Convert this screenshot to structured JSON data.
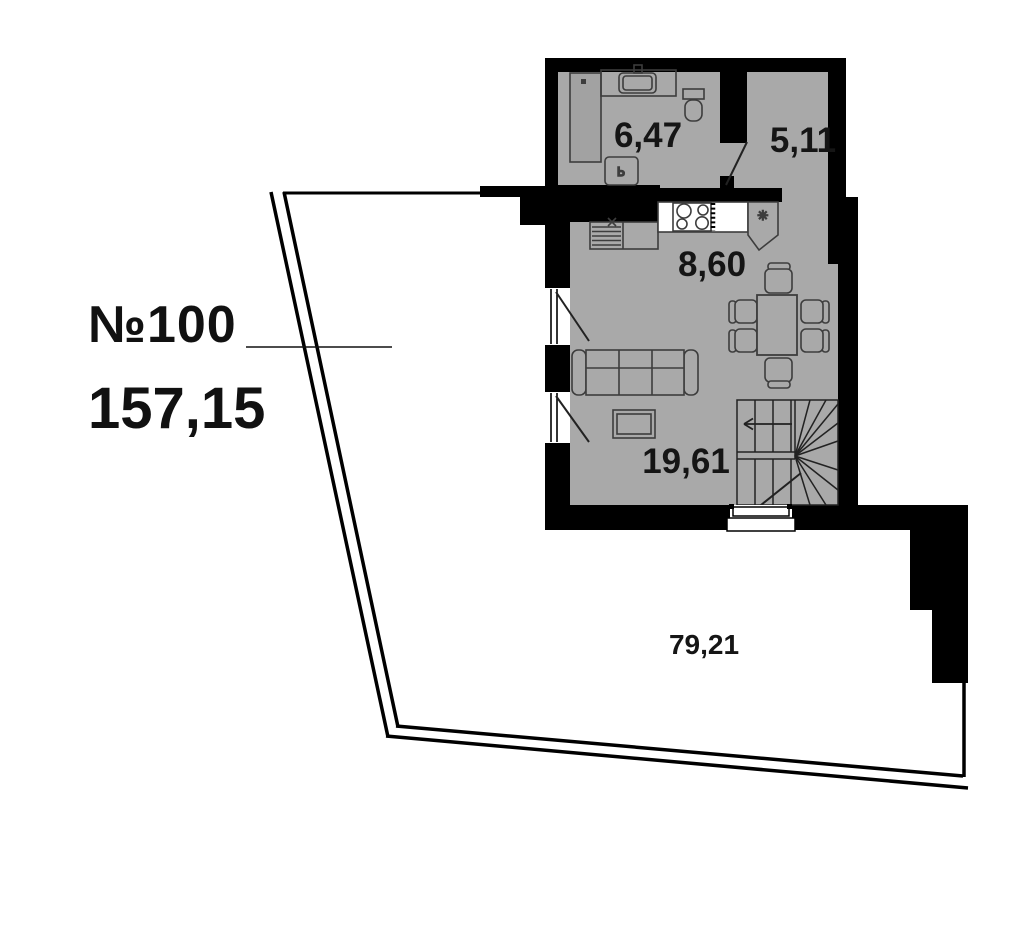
{
  "plan": {
    "apartment_label": "№100",
    "total_area": "157,15",
    "rooms": [
      {
        "name": "bathroom",
        "area": "6,47"
      },
      {
        "name": "hall-room",
        "area": "5,11"
      },
      {
        "name": "kitchen",
        "area": "8,60"
      },
      {
        "name": "living-room",
        "area": "19,61"
      },
      {
        "name": "terrace",
        "area": "79,21"
      }
    ],
    "icons": {
      "boiler": "✳",
      "washer": "Ь"
    },
    "colors": {
      "floor": "#a9a9a9",
      "wall": "#000000",
      "furniture_line": "#3d3d3d",
      "background": "#ffffff"
    }
  }
}
